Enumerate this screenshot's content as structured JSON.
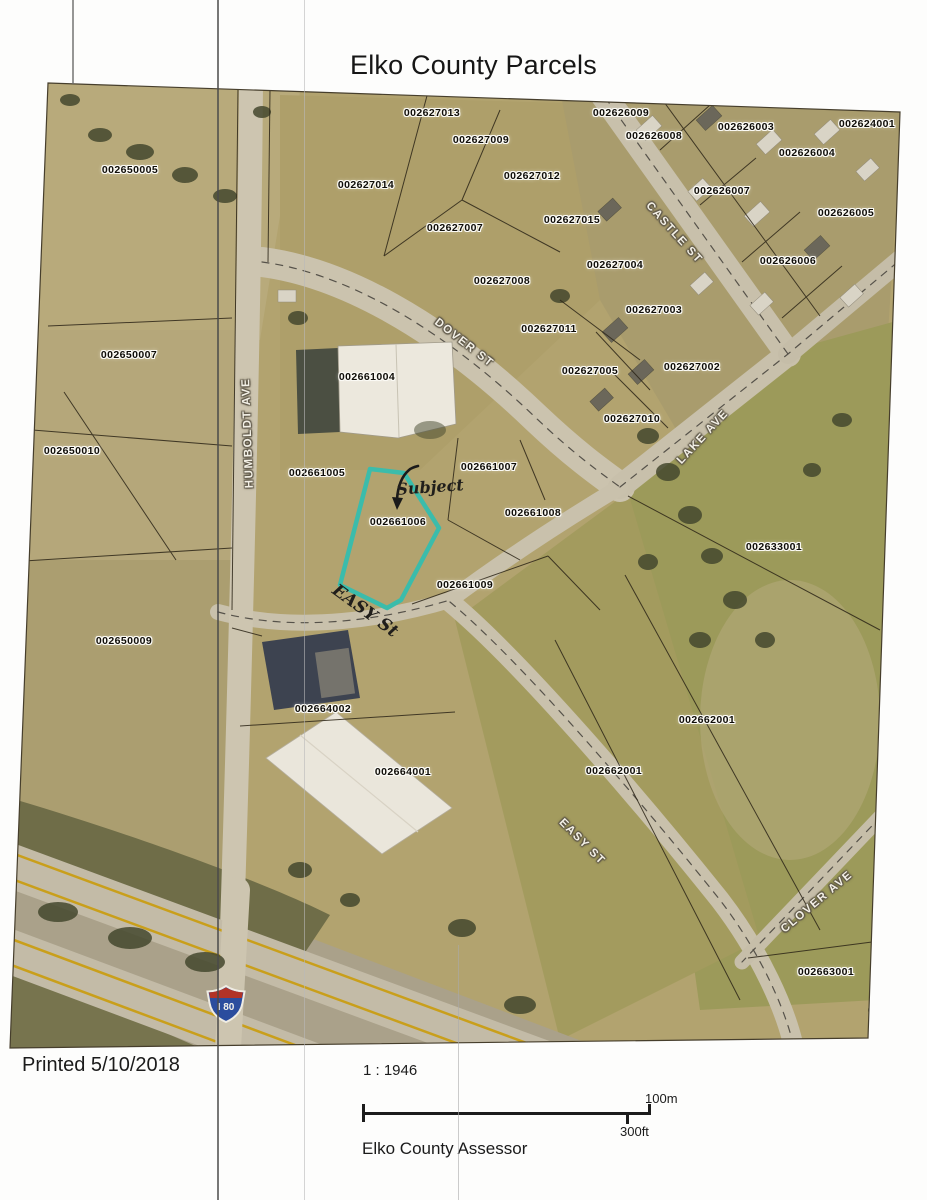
{
  "title": "Elko County Parcels",
  "map": {
    "subject": {
      "parcel_id": "002661006",
      "outline_color": "#3bbcab"
    },
    "interstate_shield": {
      "label": "I 80"
    },
    "parcel_labels": [
      {
        "id": "002627013",
        "x": 432,
        "y": 113
      },
      {
        "id": "002626009",
        "x": 621,
        "y": 113
      },
      {
        "id": "002626003",
        "x": 746,
        "y": 127
      },
      {
        "id": "002624001",
        "x": 867,
        "y": 124
      },
      {
        "id": "002627009",
        "x": 481,
        "y": 140
      },
      {
        "id": "002626008",
        "x": 654,
        "y": 136
      },
      {
        "id": "002626004",
        "x": 807,
        "y": 153
      },
      {
        "id": "002650005",
        "x": 130,
        "y": 170
      },
      {
        "id": "002627014",
        "x": 366,
        "y": 185
      },
      {
        "id": "002627012",
        "x": 532,
        "y": 176
      },
      {
        "id": "002626007",
        "x": 722,
        "y": 191
      },
      {
        "id": "002626005",
        "x": 846,
        "y": 213
      },
      {
        "id": "002627015",
        "x": 572,
        "y": 220
      },
      {
        "id": "002627007",
        "x": 455,
        "y": 228
      },
      {
        "id": "002626006",
        "x": 788,
        "y": 261
      },
      {
        "id": "002627004",
        "x": 615,
        "y": 265
      },
      {
        "id": "002627008",
        "x": 502,
        "y": 281
      },
      {
        "id": "002627003",
        "x": 654,
        "y": 310
      },
      {
        "id": "002627011",
        "x": 549,
        "y": 329
      },
      {
        "id": "002650007",
        "x": 129,
        "y": 355
      },
      {
        "id": "002627005",
        "x": 590,
        "y": 371
      },
      {
        "id": "002627002",
        "x": 692,
        "y": 367
      },
      {
        "id": "002661004",
        "x": 367,
        "y": 377
      },
      {
        "id": "002627010",
        "x": 632,
        "y": 419
      },
      {
        "id": "002650010",
        "x": 72,
        "y": 451
      },
      {
        "id": "002661007",
        "x": 489,
        "y": 467
      },
      {
        "id": "002661005",
        "x": 317,
        "y": 473
      },
      {
        "id": "002661008",
        "x": 533,
        "y": 513
      },
      {
        "id": "002661006",
        "x": 398,
        "y": 522
      },
      {
        "id": "002633001",
        "x": 774,
        "y": 547
      },
      {
        "id": "002661009",
        "x": 465,
        "y": 585
      },
      {
        "id": "002650009",
        "x": 124,
        "y": 641
      },
      {
        "id": "002664002",
        "x": 323,
        "y": 709
      },
      {
        "id": "002662001",
        "x": 707,
        "y": 720
      },
      {
        "id": "002664001",
        "x": 403,
        "y": 772
      },
      {
        "id": "002662001",
        "x": 614,
        "y": 771
      },
      {
        "id": "002663001",
        "x": 826,
        "y": 972
      }
    ],
    "street_labels": [
      {
        "name": "CASTLE ST",
        "x": 674,
        "y": 233,
        "rot": 48
      },
      {
        "name": "DOVER ST",
        "x": 464,
        "y": 343,
        "rot": 38
      },
      {
        "name": "LAKE AVE",
        "x": 703,
        "y": 437,
        "rot": -47
      },
      {
        "name": "HUMBOLDT AVE",
        "x": 248,
        "y": 433,
        "rot": -92
      },
      {
        "name": "EASY ST",
        "x": 582,
        "y": 842,
        "rot": 45
      },
      {
        "name": "CLOVER AVE",
        "x": 817,
        "y": 902,
        "rot": -40
      }
    ],
    "handwritten": [
      {
        "text": "Subject",
        "x": 430,
        "y": 487,
        "rot": -4,
        "size": 16
      },
      {
        "text": "EASY St",
        "x": 365,
        "y": 611,
        "rot": 36,
        "size": 17
      }
    ]
  },
  "footer": {
    "printed": "Printed 5/10/2018",
    "scale_ratio": "1 : 1946",
    "scale_top": "100m",
    "scale_bottom": "300ft",
    "source": "Elko County Assessor"
  }
}
